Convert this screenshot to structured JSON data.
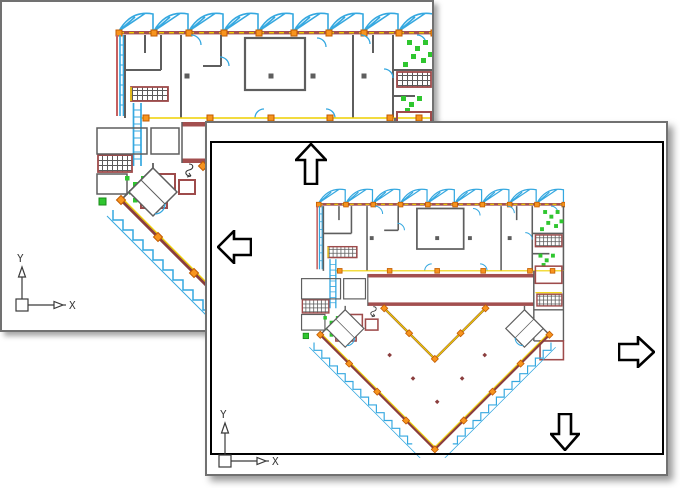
{
  "scene": {
    "description": "Two overlapping CAD drawing views of an architectural floor plan illustrating real-time pan",
    "drawing_subject": "building floor plan with diamond-shaped atrium"
  },
  "colors": {
    "window_border_gray": "#717171",
    "viewport_border_black": "#000000",
    "wall_gray": "#5E5E5E",
    "masonry_red": "#A34F4F",
    "dark_red": "#8B3E3E",
    "accent_yellow": "#EFD000",
    "marker_orange": "#F7941E",
    "glazing_cyan": "#35A8E0",
    "plant_green": "#2FC62F"
  },
  "background_window": {
    "ucs": {
      "x_label": "X",
      "y_label": "Y"
    }
  },
  "foreground_window": {
    "ucs": {
      "x_label": "X",
      "y_label": "Y"
    },
    "pan_arrows": [
      {
        "direction": "up"
      },
      {
        "direction": "left"
      },
      {
        "direction": "right"
      },
      {
        "direction": "down"
      }
    ]
  }
}
